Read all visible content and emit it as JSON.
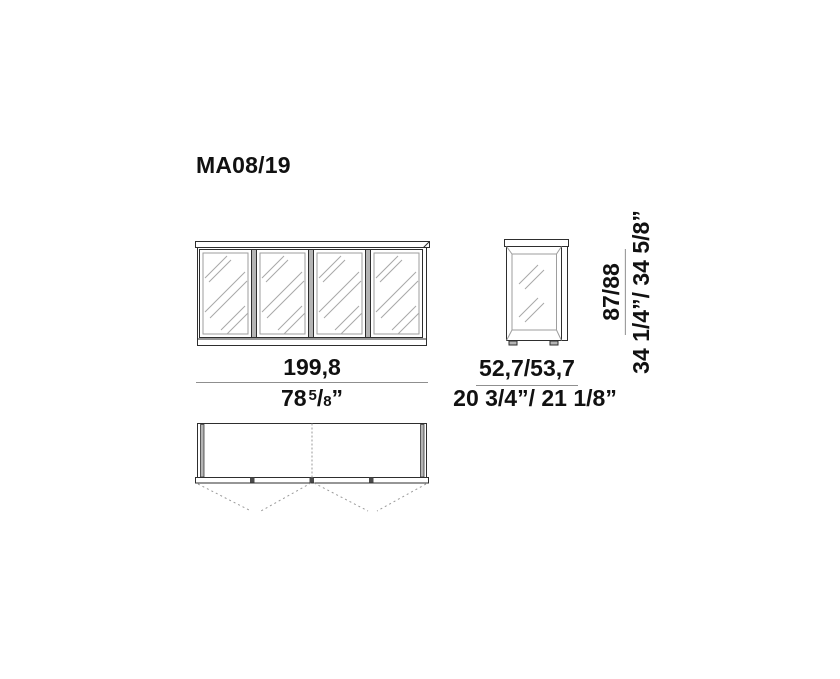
{
  "title": "MA08/19",
  "dimensions": {
    "front_width": {
      "metric": "199,8",
      "imperial_whole": "78",
      "imperial_frac_numerator": "5",
      "imperial_frac_slash": "/",
      "imperial_frac_denominator": "8",
      "imperial_unit": "”"
    },
    "side_depth": {
      "metric": "52,7/53,7",
      "imperial": "20 3/4”/ 21 1/8”"
    },
    "height": {
      "metric": "87/88",
      "imperial": "34 1/4”/ 34 5/8”"
    }
  },
  "colors": {
    "line": "#2e2e2e",
    "frame-light": "#9e9e9e",
    "hatch": "#a8a8a8",
    "gray-fill": "#b4b4b4",
    "dash": "#9a9a9a",
    "dim-line": "#8f8f8f",
    "text": "#111111"
  }
}
